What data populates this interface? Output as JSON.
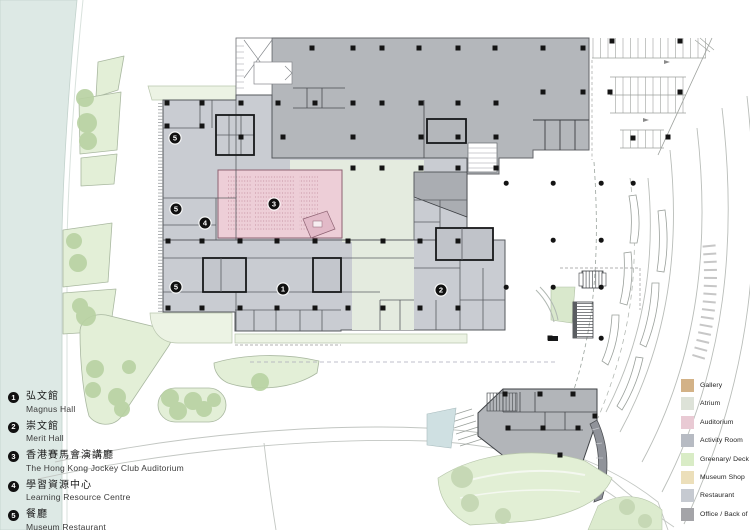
{
  "plan": {
    "markers": [
      {
        "label": "1",
        "x": 283,
        "y": 289
      },
      {
        "label": "2",
        "x": 441,
        "y": 290
      },
      {
        "label": "3",
        "x": 274,
        "y": 204
      },
      {
        "label": "4",
        "x": 205,
        "y": 223
      },
      {
        "label": "5",
        "x": 175,
        "y": 138
      },
      {
        "label": "5",
        "x": 176,
        "y": 209
      },
      {
        "label": "5",
        "x": 176,
        "y": 287
      }
    ],
    "columns": {
      "squares": [
        [
          312,
          48
        ],
        [
          353,
          48
        ],
        [
          382,
          48
        ],
        [
          419,
          48
        ],
        [
          458,
          48
        ],
        [
          495,
          48
        ],
        [
          543,
          48
        ],
        [
          583,
          48
        ],
        [
          543,
          92
        ],
        [
          583,
          92
        ],
        [
          167,
          103
        ],
        [
          202,
          103
        ],
        [
          241,
          103
        ],
        [
          278,
          103
        ],
        [
          315,
          103
        ],
        [
          353,
          103
        ],
        [
          382,
          103
        ],
        [
          421,
          103
        ],
        [
          458,
          103
        ],
        [
          496,
          103
        ],
        [
          167,
          126
        ],
        [
          202,
          126
        ],
        [
          241,
          137
        ],
        [
          283,
          137
        ],
        [
          353,
          137
        ],
        [
          421,
          137
        ],
        [
          458,
          137
        ],
        [
          496,
          137
        ],
        [
          353,
          168
        ],
        [
          382,
          168
        ],
        [
          421,
          168
        ],
        [
          458,
          168
        ],
        [
          496,
          168
        ],
        [
          168,
          241
        ],
        [
          202,
          241
        ],
        [
          240,
          241
        ],
        [
          277,
          241
        ],
        [
          315,
          241
        ],
        [
          348,
          241
        ],
        [
          383,
          241
        ],
        [
          420,
          241
        ],
        [
          458,
          241
        ],
        [
          168,
          308
        ],
        [
          202,
          308
        ],
        [
          240,
          308
        ],
        [
          277,
          308
        ],
        [
          315,
          308
        ],
        [
          348,
          308
        ],
        [
          383,
          308
        ],
        [
          420,
          308
        ],
        [
          458,
          308
        ],
        [
          612,
          41
        ],
        [
          680,
          41
        ],
        [
          610,
          92
        ],
        [
          680,
          92
        ],
        [
          633,
          138
        ],
        [
          668,
          137
        ],
        [
          505,
          394
        ],
        [
          540,
          394
        ],
        [
          573,
          394
        ],
        [
          508,
          428
        ],
        [
          543,
          428
        ],
        [
          578,
          428
        ],
        [
          560,
          455
        ],
        [
          595,
          416
        ],
        [
          550,
          338
        ]
      ],
      "dots": [
        [
          506,
          183
        ],
        [
          553,
          183
        ],
        [
          601,
          183
        ],
        [
          633,
          183
        ],
        [
          553,
          240
        ],
        [
          601,
          240
        ],
        [
          506,
          287
        ],
        [
          553,
          287
        ],
        [
          601,
          287
        ],
        [
          601,
          338
        ]
      ]
    }
  },
  "key_legend": {
    "items": [
      {
        "number": "1",
        "zh": "弘文館",
        "en": "Magnus Hall"
      },
      {
        "number": "2",
        "zh": "崇文館",
        "en": "Merit Hall"
      },
      {
        "number": "3",
        "zh": "香港賽馬會演講廳",
        "en": "The Hong Kong Jockey Club Auditorium"
      },
      {
        "number": "4",
        "zh": "學習資源中心",
        "en": "Learning Resource Centre"
      },
      {
        "number": "5",
        "zh": "餐廳",
        "en": "Museum Restaurant"
      }
    ]
  },
  "color_legend": {
    "items": [
      {
        "label": "Gallery",
        "color": "#d3b287"
      },
      {
        "label": "Atrium",
        "color": "#dde2d8"
      },
      {
        "label": "Auditorium",
        "color": "#e9cad4"
      },
      {
        "label": "Activity Room",
        "color": "#b7bbc3"
      },
      {
        "label": "Greenary/ Deck",
        "color": "#d9ecc6"
      },
      {
        "label": "Museum Shop",
        "color": "#ecdfba"
      },
      {
        "label": "Restaurant",
        "color": "#c6cad1"
      },
      {
        "label": "Office / Back of House",
        "color": "#a4a4a8"
      }
    ]
  }
}
